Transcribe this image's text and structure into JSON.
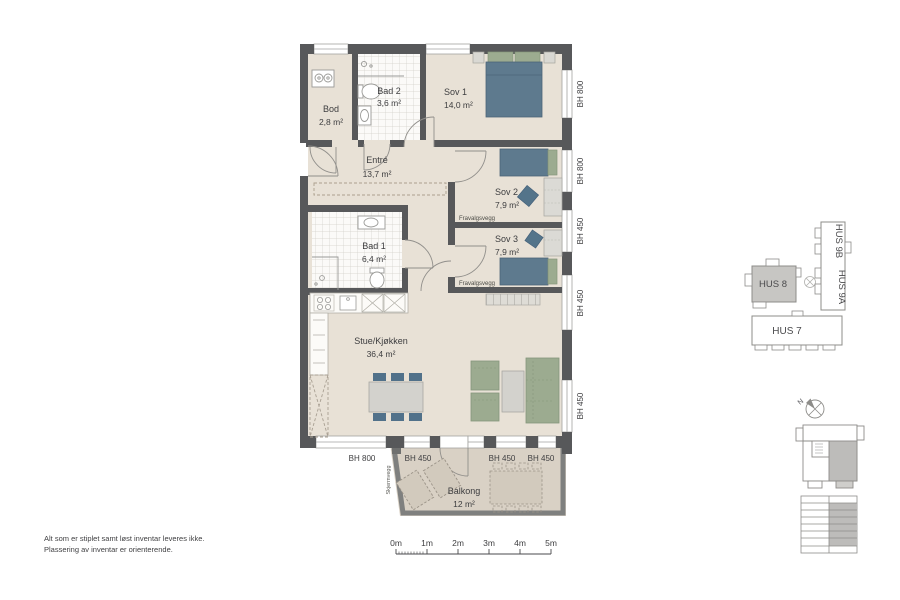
{
  "rooms": {
    "bod": {
      "name": "Bod",
      "area": "2,8 m²"
    },
    "bad2": {
      "name": "Bad 2",
      "area": "3,6 m²"
    },
    "sov1": {
      "name": "Sov 1",
      "area": "14,0 m²"
    },
    "entre": {
      "name": "Entré",
      "area": "13,7 m²"
    },
    "sov2": {
      "name": "Sov 2",
      "area": "7,9 m²"
    },
    "sov3": {
      "name": "Sov 3",
      "area": "7,9 m²"
    },
    "bad1": {
      "name": "Bad 1",
      "area": "6,4 m²"
    },
    "stue": {
      "name": "Stue/Kjøkken",
      "area": "36,4 m²"
    },
    "balkong": {
      "name": "Balkong",
      "area": "12 m²"
    }
  },
  "wall_labels": {
    "fravalgsvegg_1": "Fravalgsvegg",
    "fravalgsvegg_2": "Fravalgsvegg",
    "skjermvegg": "Skjermvegg"
  },
  "window_heights": {
    "right": [
      "BH 800",
      "BH 800",
      "BH 450",
      "BH 450",
      "BH 450"
    ],
    "bottom": [
      "BH 800",
      "BH 450",
      "BH 450",
      "BH 450"
    ]
  },
  "site_plan": {
    "hus8": "HUS 8",
    "hus9b": "HUS 9B",
    "hus9a": "HUS 9A",
    "hus7": "HUS 7",
    "north": "N"
  },
  "scale_bar": {
    "labels": [
      "0m",
      "1m",
      "2m",
      "3m",
      "4m",
      "5m"
    ]
  },
  "notes": {
    "line1": "Alt som er stiplet samt løst inventar leveres ikke.",
    "line2": "Plassering av inventar er orienterende."
  },
  "colors": {
    "wall": "#57585a",
    "floor": "#e8e1d6",
    "balcony_floor": "#d9d1c5",
    "bed": "#5e7a8e",
    "seating_green": "#9cab90",
    "furniture_gray": "#d3d2cd",
    "site_highlight": "#c7c6c3",
    "text": "#3d3d3f"
  }
}
